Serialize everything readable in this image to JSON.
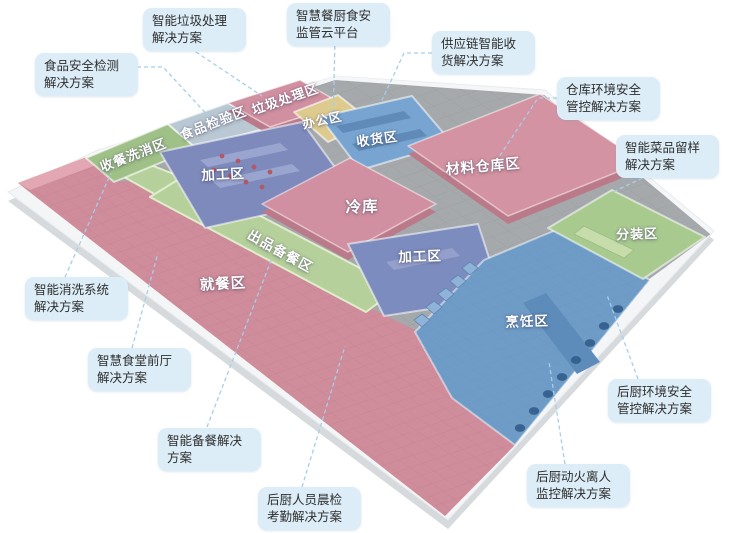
{
  "palette": {
    "background": "#ffffff",
    "slab_top": "#f3f5f6",
    "slab_side": "#d6dadd",
    "floor_gray": "#a6a9ac",
    "roof_side_pink": "#bb7a89",
    "label_box_bg": "#dcedf7",
    "label_box_text": "#2e2e2e",
    "leader_line": "#a5cfe9",
    "zone_label_text": "#ffffff"
  },
  "zones": [
    {
      "id": "wash-return",
      "label": "收餐洗消区",
      "color": "#9fc187"
    },
    {
      "id": "inspection",
      "label": "食品检验区",
      "color": "#bac8d3"
    },
    {
      "id": "trash",
      "label": "垃圾处理区",
      "color": "#d190a1"
    },
    {
      "id": "office",
      "label": "办公区",
      "color": "#ddca8e"
    },
    {
      "id": "receiving",
      "label": "收货区",
      "color": "#77a4d0"
    },
    {
      "id": "warehouse",
      "label": "材料仓库区",
      "color": "#d393a2"
    },
    {
      "id": "processing-1",
      "label": "加工区",
      "color": "#7e8abc"
    },
    {
      "id": "cold-store",
      "label": "冷库",
      "color": "#d190a1"
    },
    {
      "id": "serving-prep",
      "label": "出品备餐区",
      "color": "#b5d09a"
    },
    {
      "id": "dining",
      "label": "就餐区",
      "color": "#cf8c9b"
    },
    {
      "id": "processing-2",
      "label": "加工区",
      "color": "#7d8cbe"
    },
    {
      "id": "cooking",
      "label": "烹饪区",
      "color": "#6f9cc7"
    },
    {
      "id": "packing",
      "label": "分装区",
      "color": "#a8ca8f"
    }
  ],
  "callouts": [
    {
      "id": "food-safety-testing",
      "text": "食品安全检测解决方案"
    },
    {
      "id": "smart-waste",
      "text": "智能垃圾处理解决方案"
    },
    {
      "id": "cloud-platform",
      "text": "智慧餐厨食安监管云平台"
    },
    {
      "id": "supply-chain-receiving",
      "text": "供应链智能收货解决方案"
    },
    {
      "id": "warehouse-env-control",
      "text": "仓库环境安全管控解决方案"
    },
    {
      "id": "dish-sample-retention",
      "text": "智能菜品留样解决方案"
    },
    {
      "id": "smart-washing",
      "text": "智能消洗系统解决方案"
    },
    {
      "id": "smart-front-hall",
      "text": "智慧食堂前厅解决方案"
    },
    {
      "id": "smart-meal-prep",
      "text": "智能备餐解决方案"
    },
    {
      "id": "staff-morning-check",
      "text": "后厨人员晨检考勤解决方案"
    },
    {
      "id": "open-flame-monitor",
      "text": "后厨动火离人监控解决方案"
    },
    {
      "id": "kitchen-env-control",
      "text": "后厨环境安全管控解决方案"
    }
  ]
}
